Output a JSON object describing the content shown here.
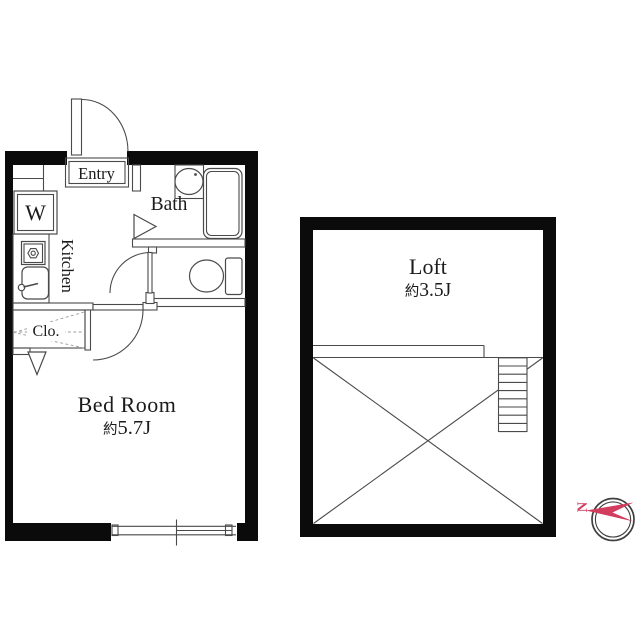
{
  "unit_plan": {
    "entry_label": "Entry",
    "washer_label": "W",
    "bath_label": "Bath",
    "kitchen_label": "Kitchen",
    "closet_label": "Clo.",
    "bedroom_label": "Bed Room",
    "bedroom_area_prefix": "約",
    "bedroom_area_value": "5.7J"
  },
  "loft_plan": {
    "loft_label": "Loft",
    "loft_area_prefix": "約",
    "loft_area_value": "3.5J"
  },
  "compass": {
    "north_label": "N"
  },
  "colors": {
    "wall_black": "#0b0b0b",
    "line_gray": "#4a4a4a",
    "dash_gray": "#999999",
    "compass_red": "#d23d5e"
  }
}
